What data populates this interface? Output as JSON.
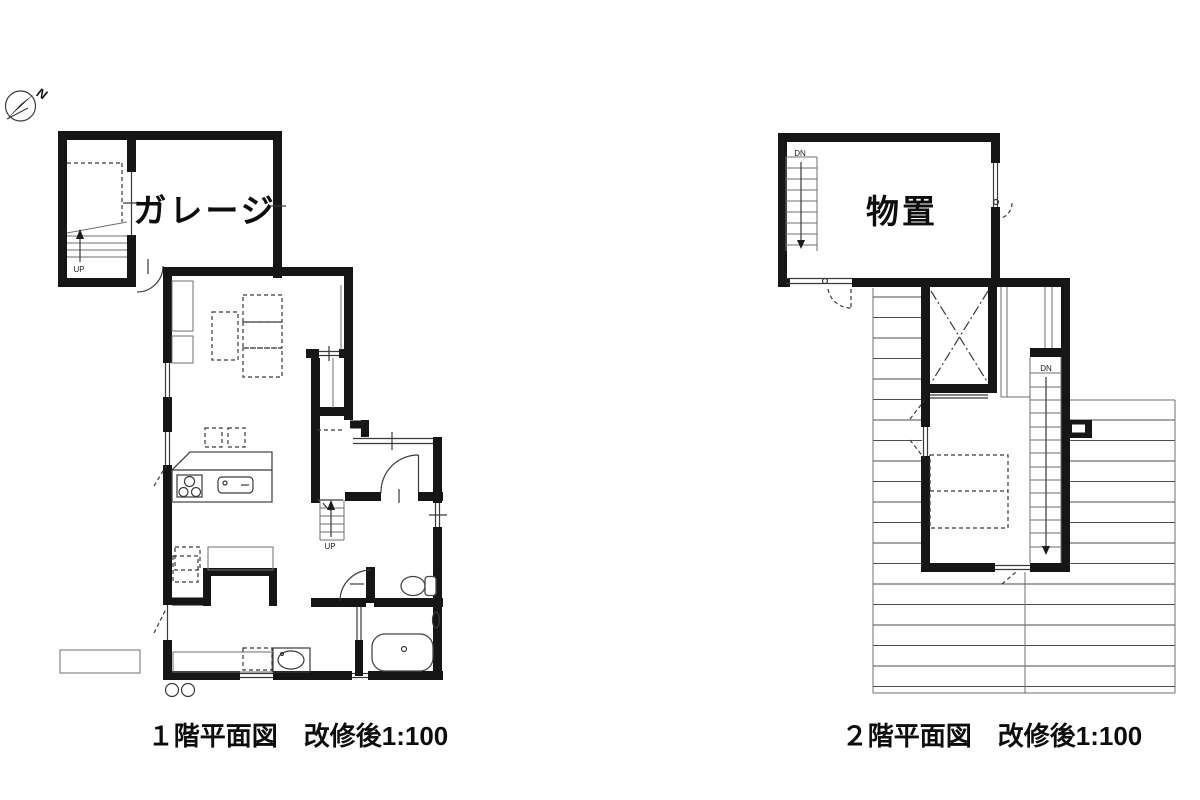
{
  "north": {
    "label": "N"
  },
  "floor1": {
    "caption_title": "１階平面図",
    "caption_scale": "改修後1:100",
    "rooms": {
      "garage": "ガレージ"
    },
    "stairs": {
      "up_label": "UP"
    }
  },
  "floor2": {
    "caption_title": "２階平面図",
    "caption_scale": "改修後1:100",
    "rooms": {
      "storage": "物置"
    },
    "stairs": {
      "down_label": "DN"
    }
  }
}
